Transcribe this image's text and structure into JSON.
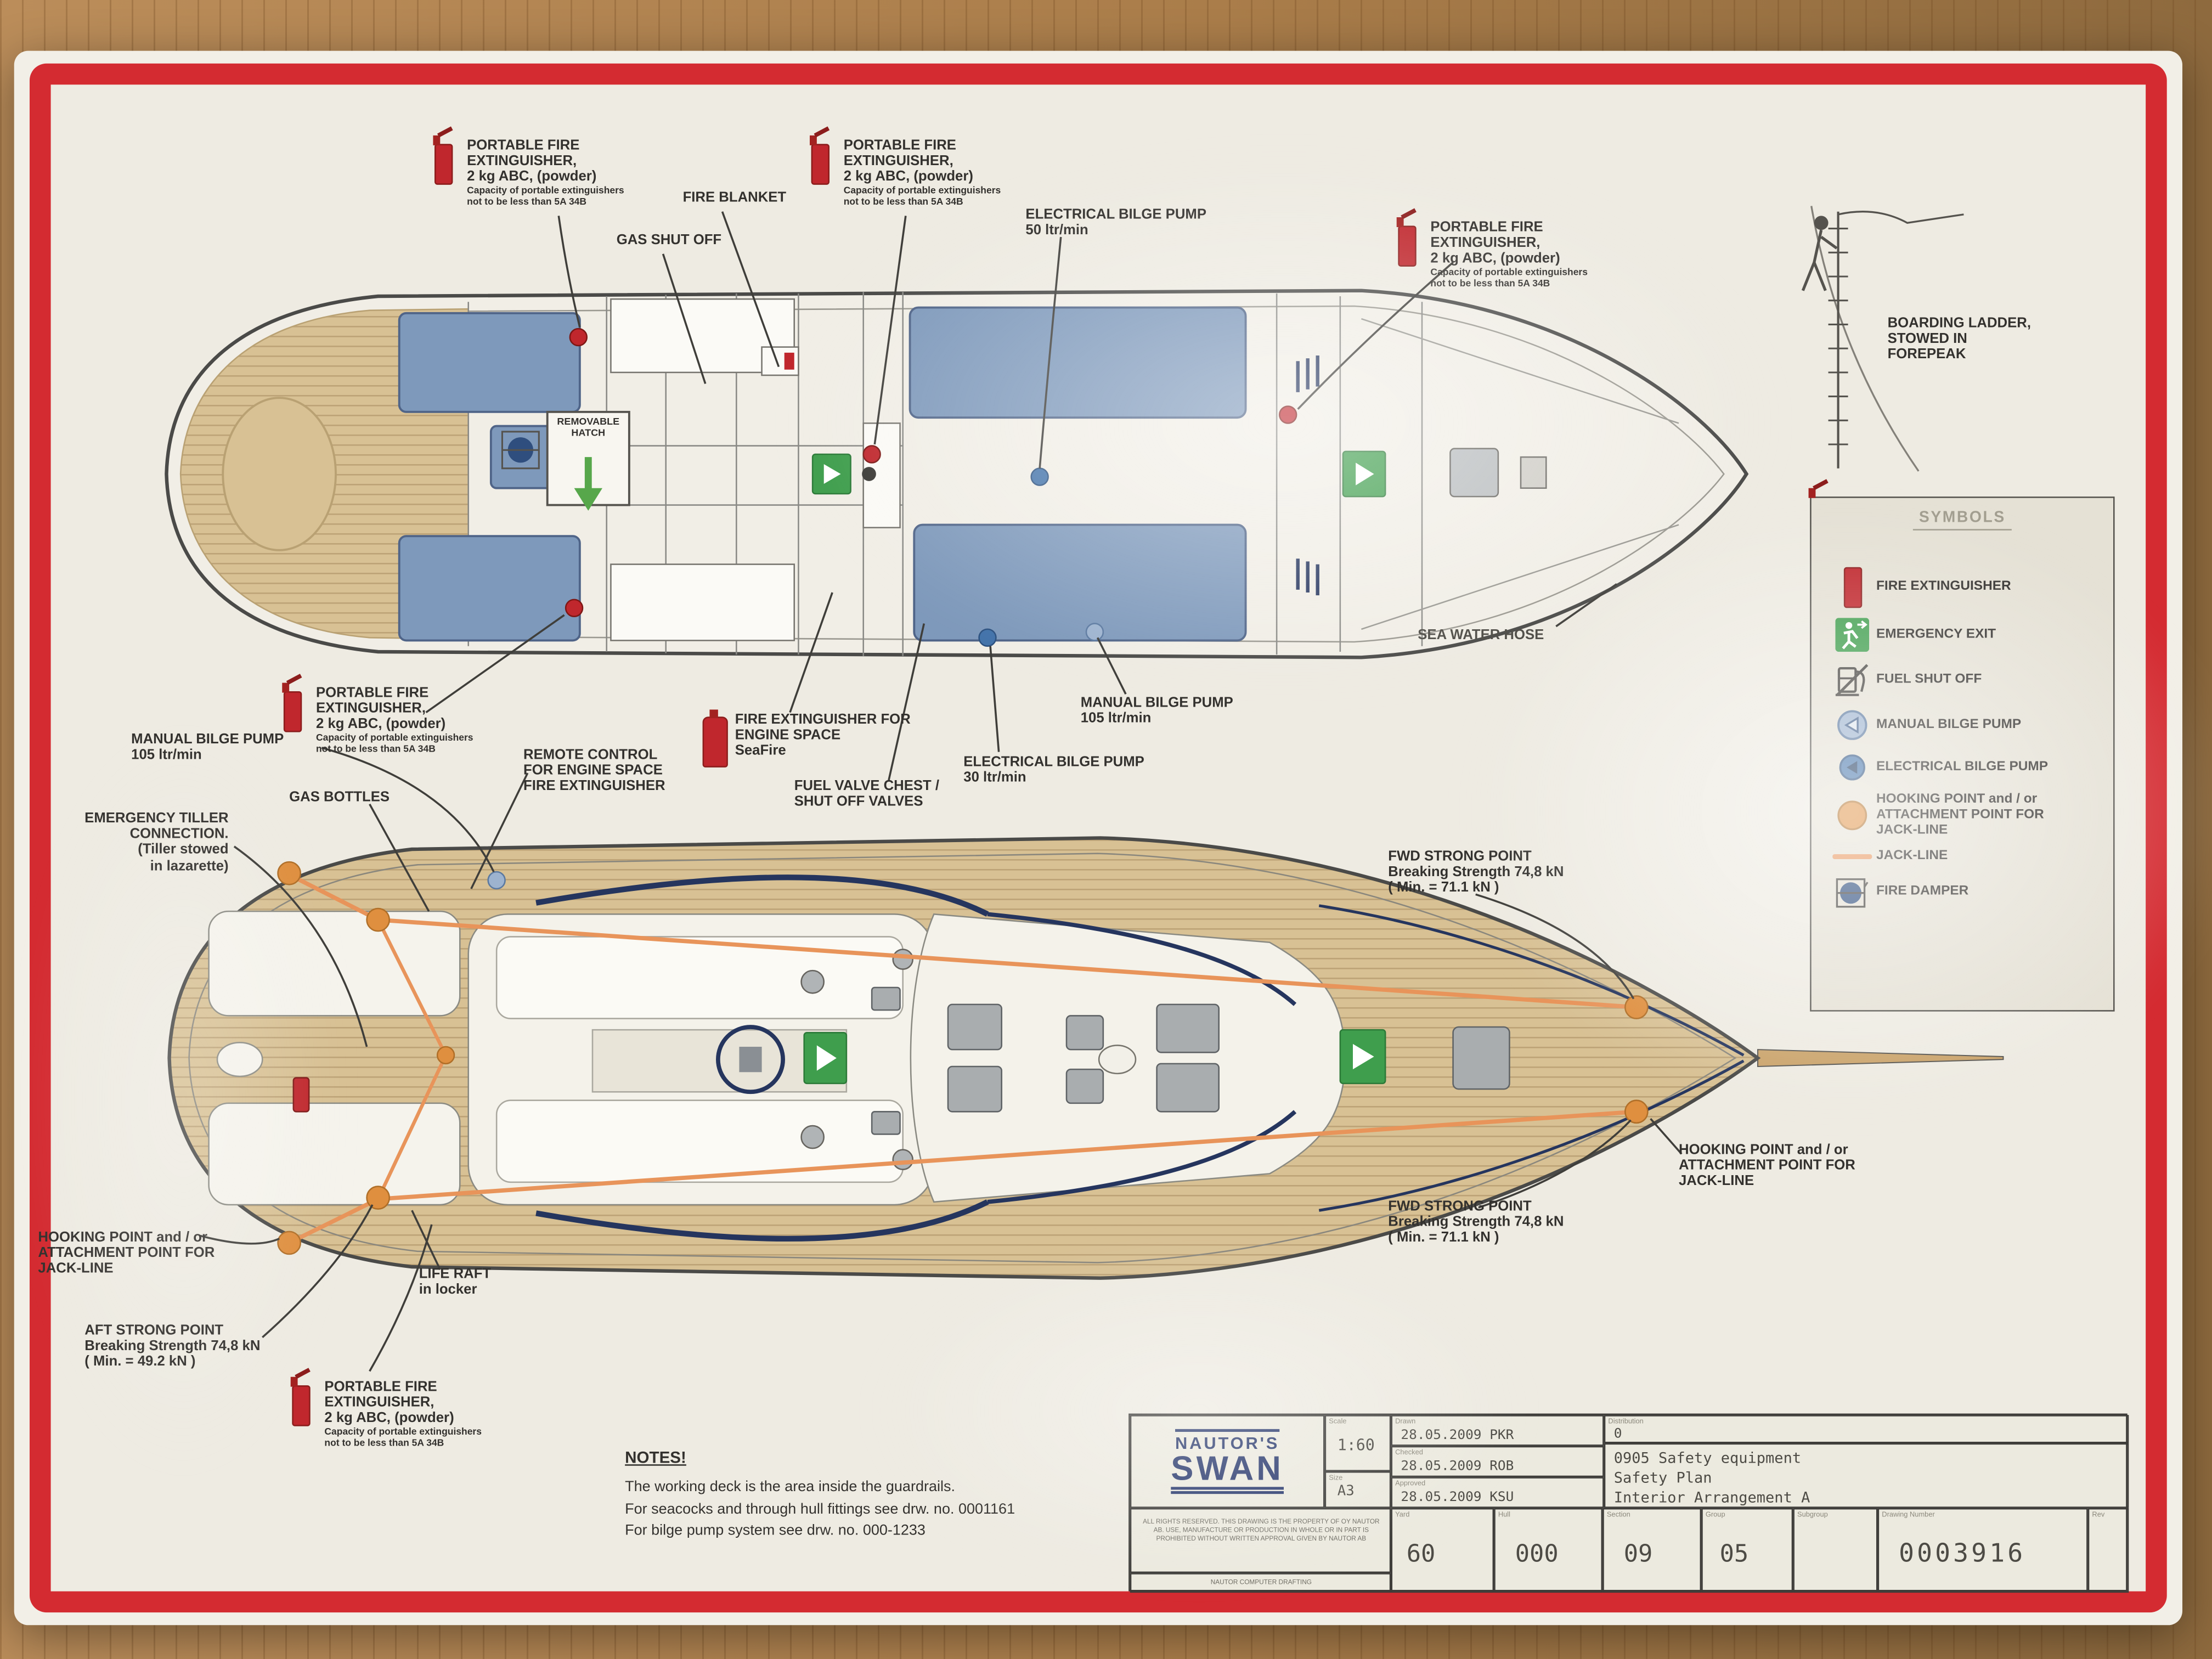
{
  "labels": {
    "portable_fire_ext": {
      "l1": "PORTABLE FIRE",
      "l2": "EXTINGUISHER,",
      "l3": "2 kg ABC, (powder)",
      "n1": "Capacity of portable extinguishers",
      "n2": "not to be less than 5A 34B"
    },
    "fire_blanket": "FIRE BLANKET",
    "gas_shut_off": "GAS SHUT OFF",
    "electrical_bilge_pump_50": {
      "l1": "ELECTRICAL BILGE PUMP",
      "l2": "50 ltr/min"
    },
    "electrical_bilge_pump_30": {
      "l1": "ELECTRICAL BILGE PUMP",
      "l2": "30 ltr/min"
    },
    "manual_bilge_pump_105": {
      "l1": "MANUAL BILGE PUMP",
      "l2": "105 ltr/min"
    },
    "boarding_ladder": {
      "l1": "BOARDING LADDER,",
      "l2": "STOWED IN",
      "l3": "FOREPEAK"
    },
    "sea_water_hose": "SEA WATER HOSE",
    "removable_hatch": {
      "l1": "REMOVABLE",
      "l2": "HATCH"
    },
    "emergency_tiller": {
      "l1": "EMERGENCY TILLER",
      "l2": "CONNECTION.",
      "l3": "(Tiller stowed",
      "l4": "in lazarette)"
    },
    "gas_bottles": "GAS BOTTLES",
    "remote_control": {
      "l1": "REMOTE CONTROL",
      "l2": "FOR ENGINE SPACE",
      "l3": "FIRE EXTINGUISHER"
    },
    "engine_extinguisher": {
      "l1": "FIRE EXTINGUISHER FOR",
      "l2": "ENGINE SPACE",
      "l3": "SeaFire"
    },
    "fuel_valve_chest": {
      "l1": "FUEL VALVE CHEST /",
      "l2": "SHUT OFF VALVES"
    },
    "fwd_strong_point": {
      "l1": "FWD STRONG POINT",
      "l2": "Breaking Strength 74,8 kN",
      "l3": "( Min. = 71.1 kN )"
    },
    "aft_strong_point": {
      "l1": "AFT STRONG POINT",
      "l2": "Breaking Strength 74,8 kN",
      "l3": "( Min. = 49.2 kN )"
    },
    "hooking_point": {
      "l1": "HOOKING POINT and / or",
      "l2": "ATTACHMENT POINT FOR",
      "l3": "JACK-LINE"
    },
    "life_raft": {
      "l1": "LIFE RAFT",
      "l2": "in locker"
    }
  },
  "legend": {
    "title": "SYMBOLS",
    "items": [
      {
        "label": "FIRE EXTINGUISHER",
        "icon": "fire-extinguisher",
        "color": "#c0272d"
      },
      {
        "label": "EMERGENCY EXIT",
        "icon": "emergency-exit",
        "color": "#3f9e4d"
      },
      {
        "label": "FUEL SHUT OFF",
        "icon": "fuel-shut-off",
        "color": "#44423e"
      },
      {
        "label": "MANUAL BILGE PUMP",
        "icon": "manual-bilge-pump",
        "color": "#9db3cf"
      },
      {
        "label": "ELECTRICAL BILGE PUMP",
        "icon": "electrical-bilge-pump",
        "color": "#4373aa"
      },
      {
        "label": "HOOKING POINT and / or ATTACHMENT POINT FOR JACK-LINE",
        "icon": "hooking-point",
        "color": "#df8f3f"
      },
      {
        "label": "JACK-LINE",
        "icon": "jack-line",
        "color": "#e8945a"
      },
      {
        "label": "FIRE DAMPER",
        "icon": "fire-damper",
        "color": "#2f4e7e"
      }
    ]
  },
  "notes": {
    "heading": "NOTES!",
    "line1": "The working deck is the area inside the guardrails.",
    "line2": "For seacocks and through hull fittings see drw. no. 0001161",
    "line3": "For bilge pump system see drw. no. 000-1233"
  },
  "title_block": {
    "logo_line1": "NAUTOR'S",
    "logo_line2": "SWAN",
    "scale_label": "Scale",
    "scale": "1:60",
    "size_label": "Size",
    "size": "A3",
    "drawn_label": "Drawn",
    "drawn": "28.05.2009 PKR",
    "checked_label": "Checked",
    "checked": "28.05.2009 ROB",
    "approved_label": "Approved",
    "approved": "28.05.2009 KSU",
    "distribution_label": "Distribution",
    "distribution": "0",
    "title_line1": "0905 Safety equipment",
    "title_line2": "Safety Plan",
    "title_line3": "Interior Arrangement A",
    "yard_label": "Yard",
    "yard": "60",
    "hull_label": "Hull",
    "hull": "000",
    "section_label": "Section",
    "section": "09",
    "group_label": "Group",
    "group": "05",
    "subgroup_label": "Subgroup",
    "subgroup": "",
    "drawing_number_label": "Drawing Number",
    "drawing_number": "0003916",
    "rev_label": "Rev",
    "rev": "",
    "legal": "ALL RIGHTS RESERVED. THIS DRAWING IS THE PROPERTY OF OY NAUTOR AB. USE, MANUFACTURE OR PRODUCTION IN WHOLE OR IN PART IS PROHIBITED WITHOUT WRITTEN APPROVAL GIVEN BY NAUTOR AB",
    "legal2": "NAUTOR COMPUTER DRAFTING"
  }
}
